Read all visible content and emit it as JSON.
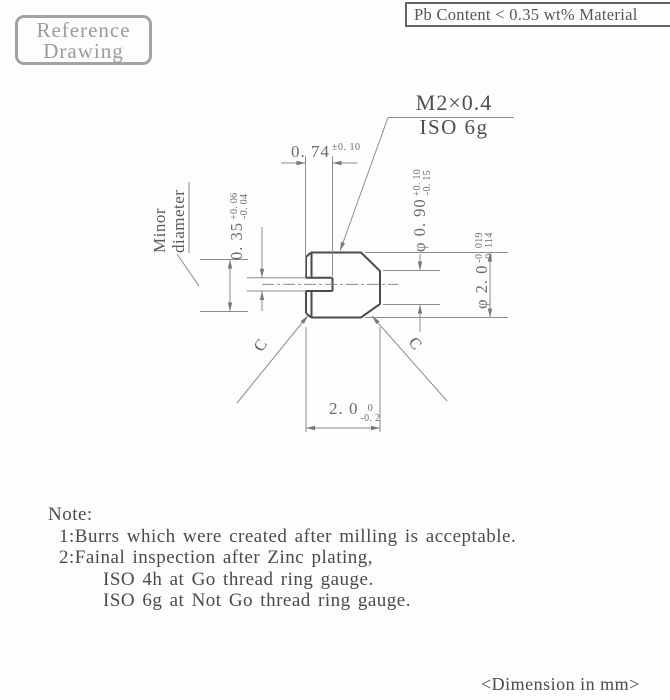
{
  "colors": {
    "line_bold": "#4a4a4a",
    "line_thin": "#8c8c8c",
    "dim_text": "#6b6b6b",
    "stamp_gray": "#9b9b9b"
  },
  "stamp": {
    "line1": "Reference",
    "line2": "Drawing"
  },
  "material_banner": "Pb Content < 0.35 wt% Material",
  "callout": {
    "thread": "M2×0.4",
    "fit": "ISO 6g"
  },
  "labels": {
    "minor_diameter_line1": "Minor",
    "minor_diameter_line2": "diameter",
    "chamfer_left": "C",
    "chamfer_right": "C"
  },
  "dimensions": {
    "slot_depth": {
      "value": "0. 74",
      "tolerance": "±0. 10"
    },
    "slot_width": {
      "value": "0. 35",
      "tol_upper": "+0. 06",
      "tol_lower": "-0. 04"
    },
    "point_diameter": {
      "value": "φ 0. 90",
      "tol_upper": "+0. 10",
      "tol_lower": "-0. 15"
    },
    "major_diameter": {
      "value": "φ 2. 0",
      "tol_upper": "-0. 019",
      "tol_lower": "-0. 114"
    },
    "length": {
      "value": "2. 0",
      "tol_upper": "0",
      "tol_lower": "-0. 2"
    }
  },
  "notes": {
    "title": "Note:",
    "item1": "1:Burrs which were created after milling is acceptable.",
    "item2": "2:Fainal inspection after Zinc plating,",
    "item2a": "ISO 4h at Go thread ring gauge.",
    "item2b": "ISO 6g at Not Go thread ring gauge."
  },
  "footer": {
    "units": "<Dimension in mm>"
  }
}
